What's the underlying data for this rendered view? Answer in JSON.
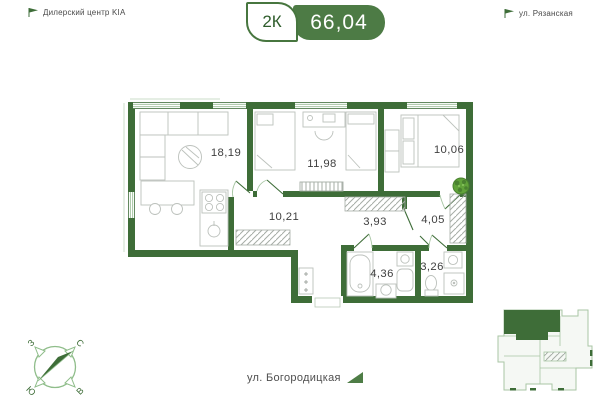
{
  "header": {
    "landmark_left": "Дилерский центр KIA",
    "street_top": "ул. Рязанская",
    "badge_rooms": "2К",
    "badge_area": "66,04"
  },
  "plan": {
    "rooms": [
      {
        "name": "living-kitchen",
        "area": "18,19"
      },
      {
        "name": "bedroom-1",
        "area": "11,98"
      },
      {
        "name": "bedroom-2",
        "area": "10,06"
      },
      {
        "name": "hallway",
        "area": "10,21"
      },
      {
        "name": "corridor",
        "area": "3,93"
      },
      {
        "name": "entry-hall",
        "area": "4,05"
      },
      {
        "name": "bathroom",
        "area": "4,36"
      },
      {
        "name": "wc",
        "area": "3,26"
      }
    ]
  },
  "compass": {
    "north": "С",
    "east": "В",
    "south": "Ю",
    "west": "З"
  },
  "footer": {
    "street_bottom": "ул. Богородицкая"
  },
  "icons": {
    "landmark_left": "flag-icon",
    "street_top": "flag-icon",
    "street_bottom": "triangle-arrow-icon",
    "plant": "plant-icon",
    "compass": "compass-icon",
    "site_plan": "building-footprint-icon"
  },
  "colors": {
    "wall_green": "#3E6D38",
    "light_green": "#A8C6A4",
    "badge_green": "#4D7B45",
    "badge_border_green": "#47763F",
    "text_dark": "#3F3F3F",
    "plant_green": "#61A33A"
  }
}
